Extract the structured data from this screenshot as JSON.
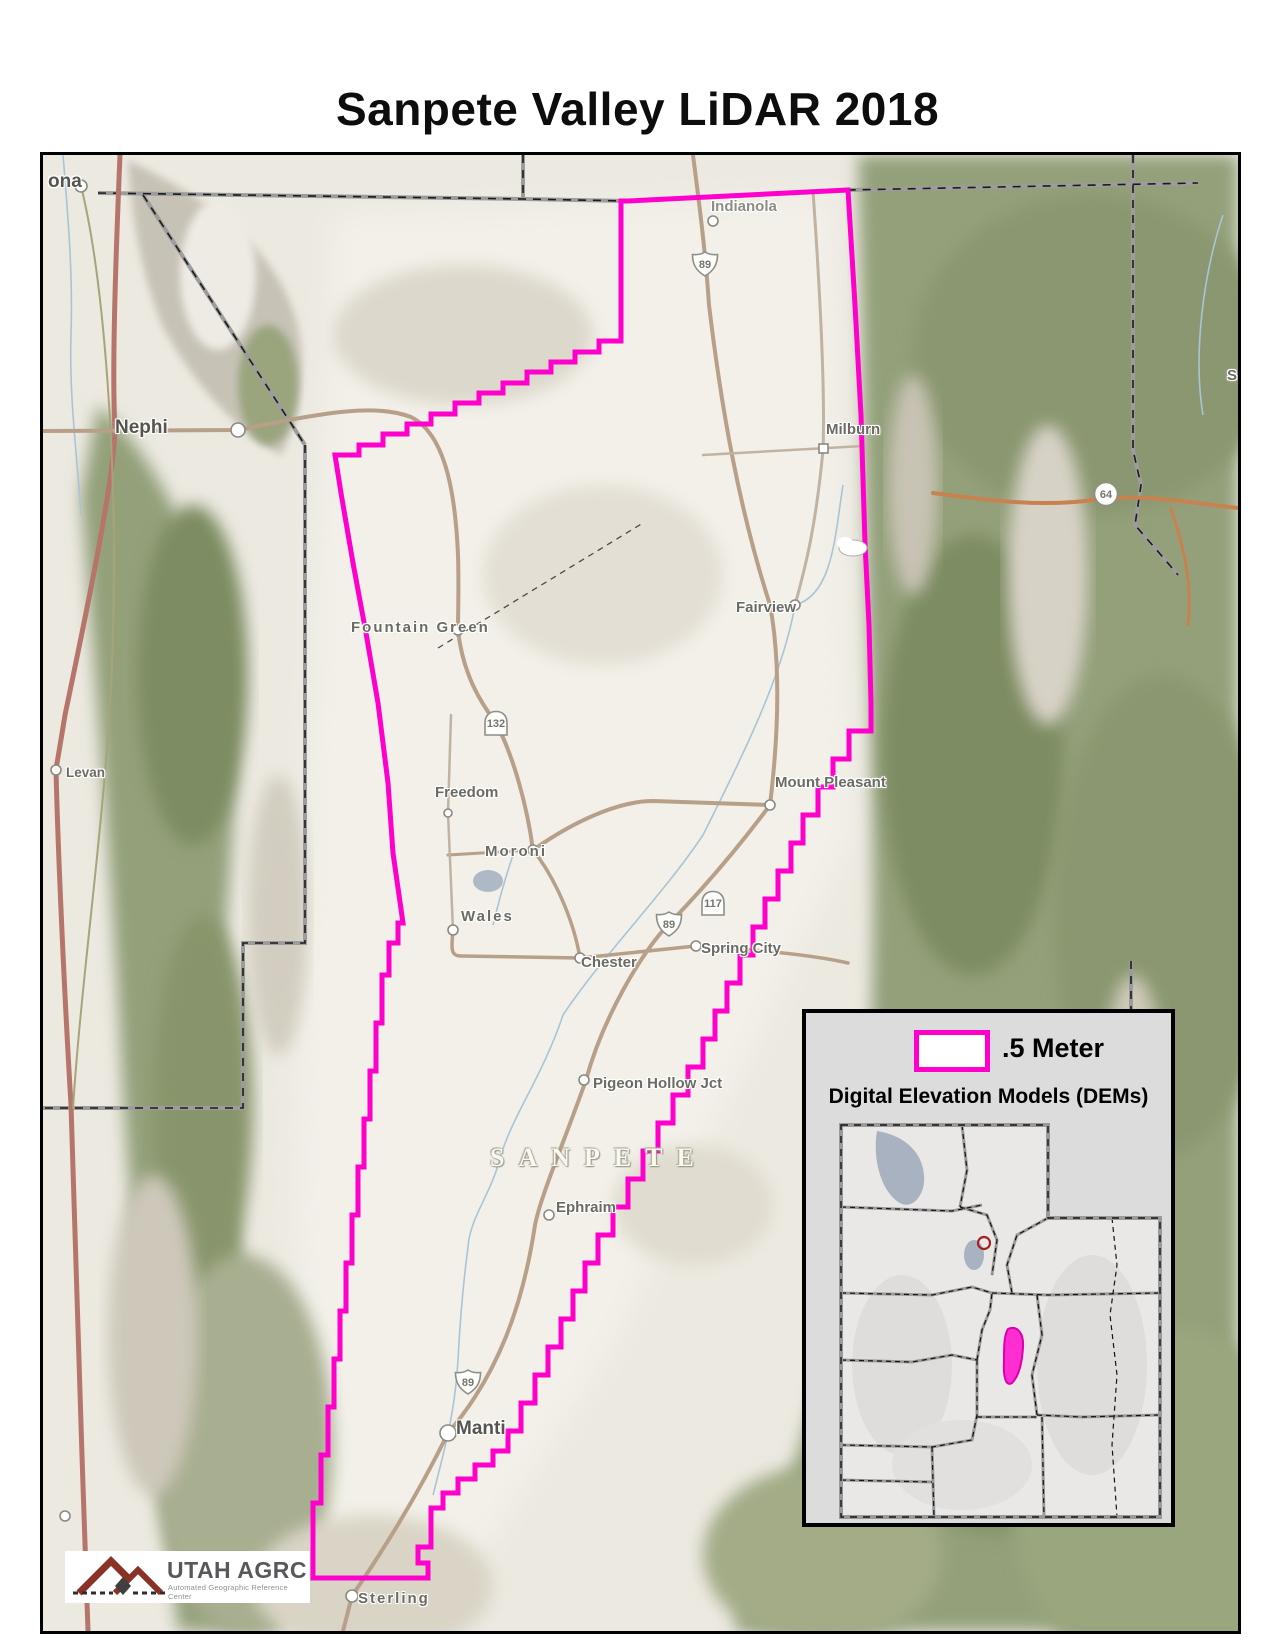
{
  "title": "Sanpete Valley LiDAR 2018",
  "accent_color": "#FF00CC",
  "map": {
    "county_label": "SANPETE",
    "towns": [
      {
        "name": "ona"
      },
      {
        "name": "Nephi"
      },
      {
        "name": "Levan"
      },
      {
        "name": "Indianola"
      },
      {
        "name": "Fountain Green"
      },
      {
        "name": "Milburn"
      },
      {
        "name": "Fairview"
      },
      {
        "name": "Freedom"
      },
      {
        "name": "Mount Pleasant"
      },
      {
        "name": "Moroni"
      },
      {
        "name": "Wales"
      },
      {
        "name": "Spring City"
      },
      {
        "name": "Chester"
      },
      {
        "name": "Pigeon Hollow Jct"
      },
      {
        "name": "Ephraim"
      },
      {
        "name": "Manti"
      },
      {
        "name": "Sterling"
      },
      {
        "name": "S"
      }
    ],
    "shields": [
      {
        "route": "89"
      },
      {
        "route": "132"
      },
      {
        "route": "117"
      },
      {
        "route": "89"
      },
      {
        "route": "89"
      },
      {
        "route": "64"
      }
    ]
  },
  "legend": {
    "swatch_label": ".5 Meter",
    "subtitle": "Digital Elevation Models (DEMs)"
  },
  "logo": {
    "name": "UTAH AGRC",
    "subtitle": "Automated Geographic Reference Center"
  }
}
